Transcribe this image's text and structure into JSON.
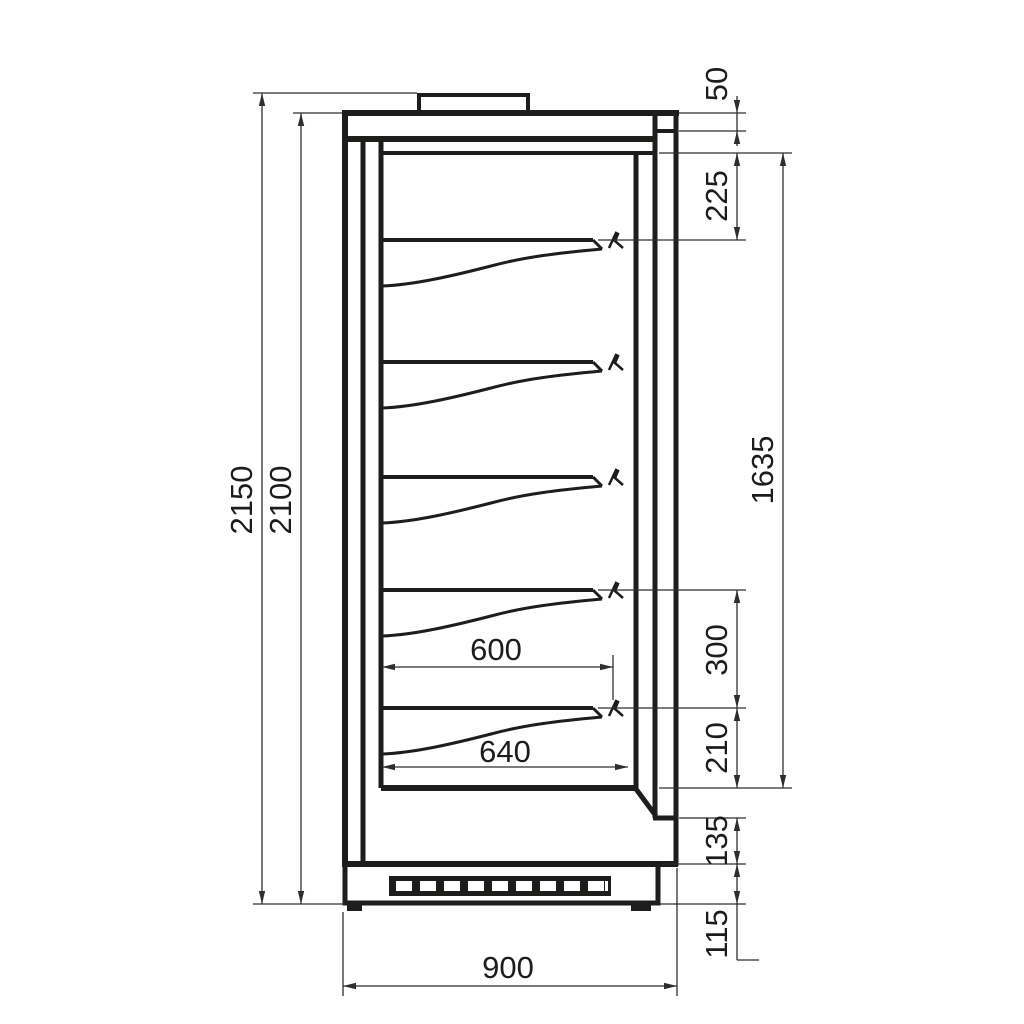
{
  "dimensions": {
    "overall_height": "2150",
    "cabinet_height": "2100",
    "top_panel_height": "50",
    "ceiling_to_first_shelf": "225",
    "display_opening_height": "1635",
    "shelf_pitch": "300",
    "bottom_shelf_to_deck": "210",
    "machine_compartment_height": "135",
    "plinth_height": "115",
    "overall_depth": "900",
    "shelf_depth": "600",
    "deck_depth": "640"
  },
  "shelves": {
    "count": 5
  },
  "colors": {
    "background": "#ffffff",
    "structure_line": "#1d1d1b",
    "dimension_line": "#2e2e2e",
    "text": "#1c1c1c"
  }
}
